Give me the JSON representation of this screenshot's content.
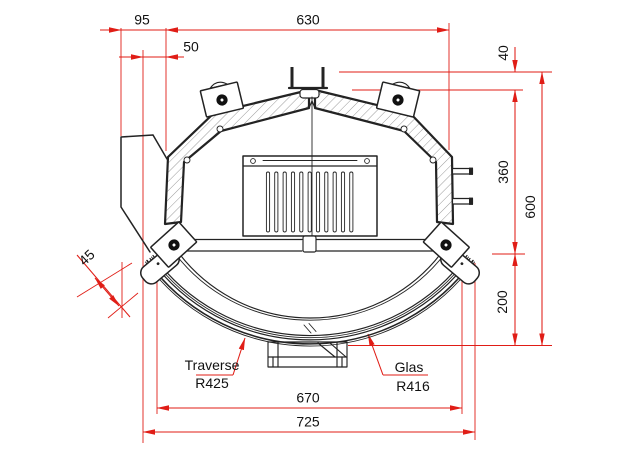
{
  "drawing": {
    "background_color": "#ffffff",
    "line_color": "#232323",
    "dimension_color": "#e01d16",
    "text_color": "#111111"
  },
  "dimensions": {
    "top_left_width": "95",
    "top_width": "630",
    "top_left_offset": "50",
    "right_top": "40",
    "right_upper": "360",
    "right_total": "600",
    "right_lower": "200",
    "left_diagonal": "45",
    "bottom_inner_width": "670",
    "bottom_total_width": "725"
  },
  "labels": {
    "traverse_name": "Traverse",
    "traverse_radius": "R425",
    "glass_name": "Glas",
    "glass_radius": "R416"
  }
}
